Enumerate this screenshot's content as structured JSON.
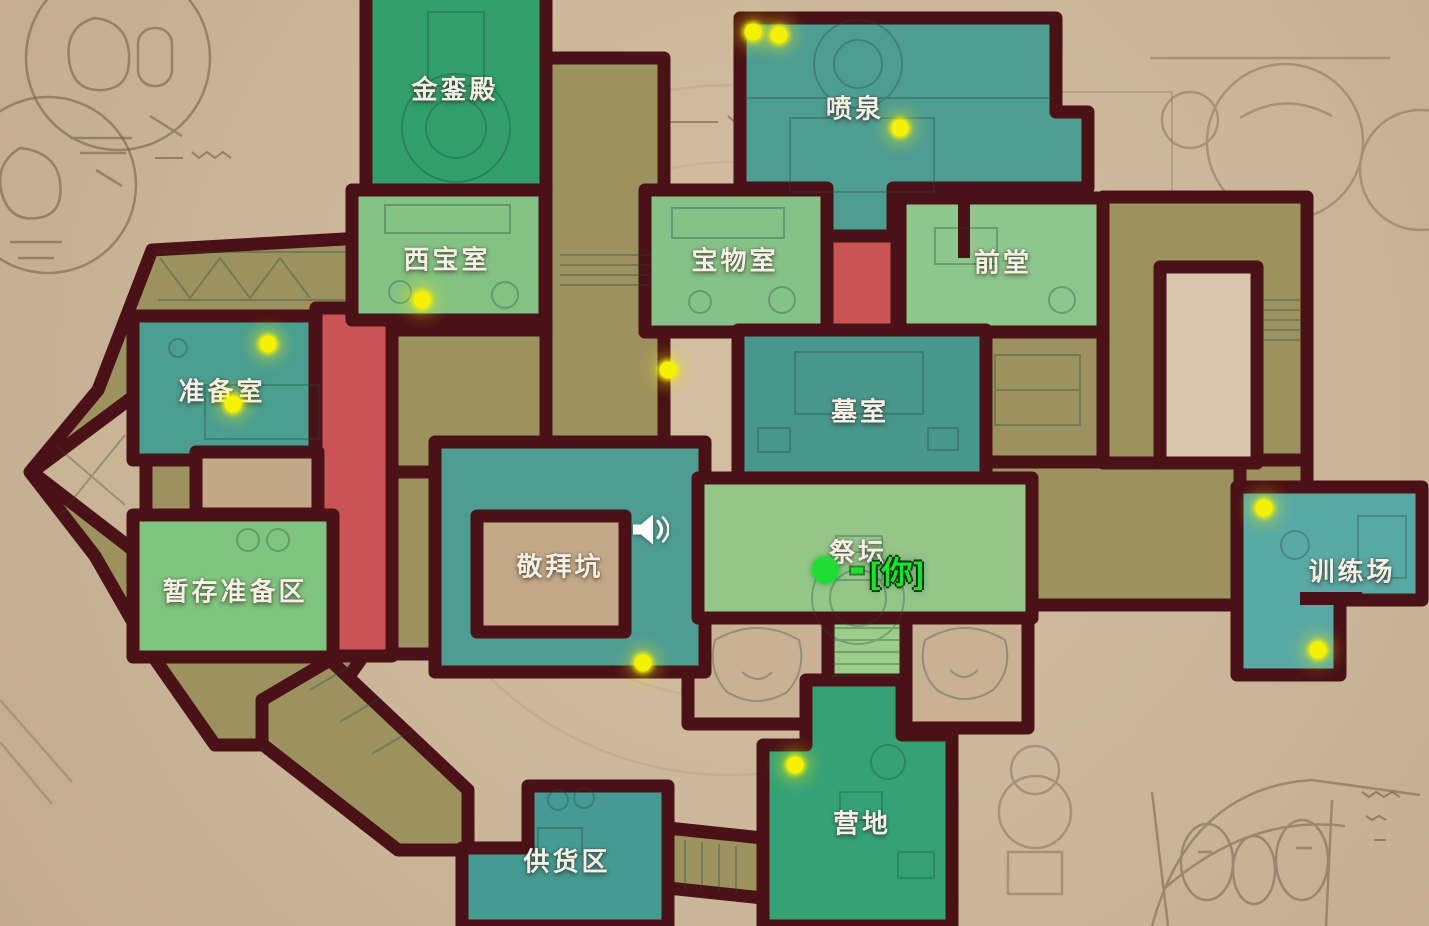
{
  "rooms": [
    {
      "name": "金銮殿"
    },
    {
      "name": "喷泉"
    },
    {
      "name": "西宝室"
    },
    {
      "name": "宝物室"
    },
    {
      "name": "前堂"
    },
    {
      "name": "准备室"
    },
    {
      "name": "墓室"
    },
    {
      "name": "敬拜坑"
    },
    {
      "name": "祭坛"
    },
    {
      "name": "暂存准备区"
    },
    {
      "name": "训练场"
    },
    {
      "name": "供货区"
    },
    {
      "name": "营地"
    }
  ],
  "tasks": [
    {
      "x": 753,
      "y": 32
    },
    {
      "x": 779,
      "y": 35
    },
    {
      "x": 900,
      "y": 128
    },
    {
      "x": 422,
      "y": 300
    },
    {
      "x": 268,
      "y": 344
    },
    {
      "x": 233,
      "y": 404
    },
    {
      "x": 668,
      "y": 370
    },
    {
      "x": 643,
      "y": 663
    },
    {
      "x": 1264,
      "y": 508
    },
    {
      "x": 1318,
      "y": 650
    },
    {
      "x": 795,
      "y": 765
    }
  ],
  "player": {
    "x": 825,
    "y": 570,
    "label": "[你]"
  },
  "speaker": {
    "x": 650,
    "y": 532
  },
  "colors": {
    "wall": "#4a1116",
    "parchment": "#ccb79b",
    "room_green": "#31a173",
    "room_light_green": "#85c285",
    "room_teal": "#4e9d93",
    "room_cyan": "#58a9a5",
    "corridor_red": "#c85553",
    "corridor_olive": "#9c925f",
    "task_dot": "#f4f104",
    "player": "#1fdc34"
  }
}
